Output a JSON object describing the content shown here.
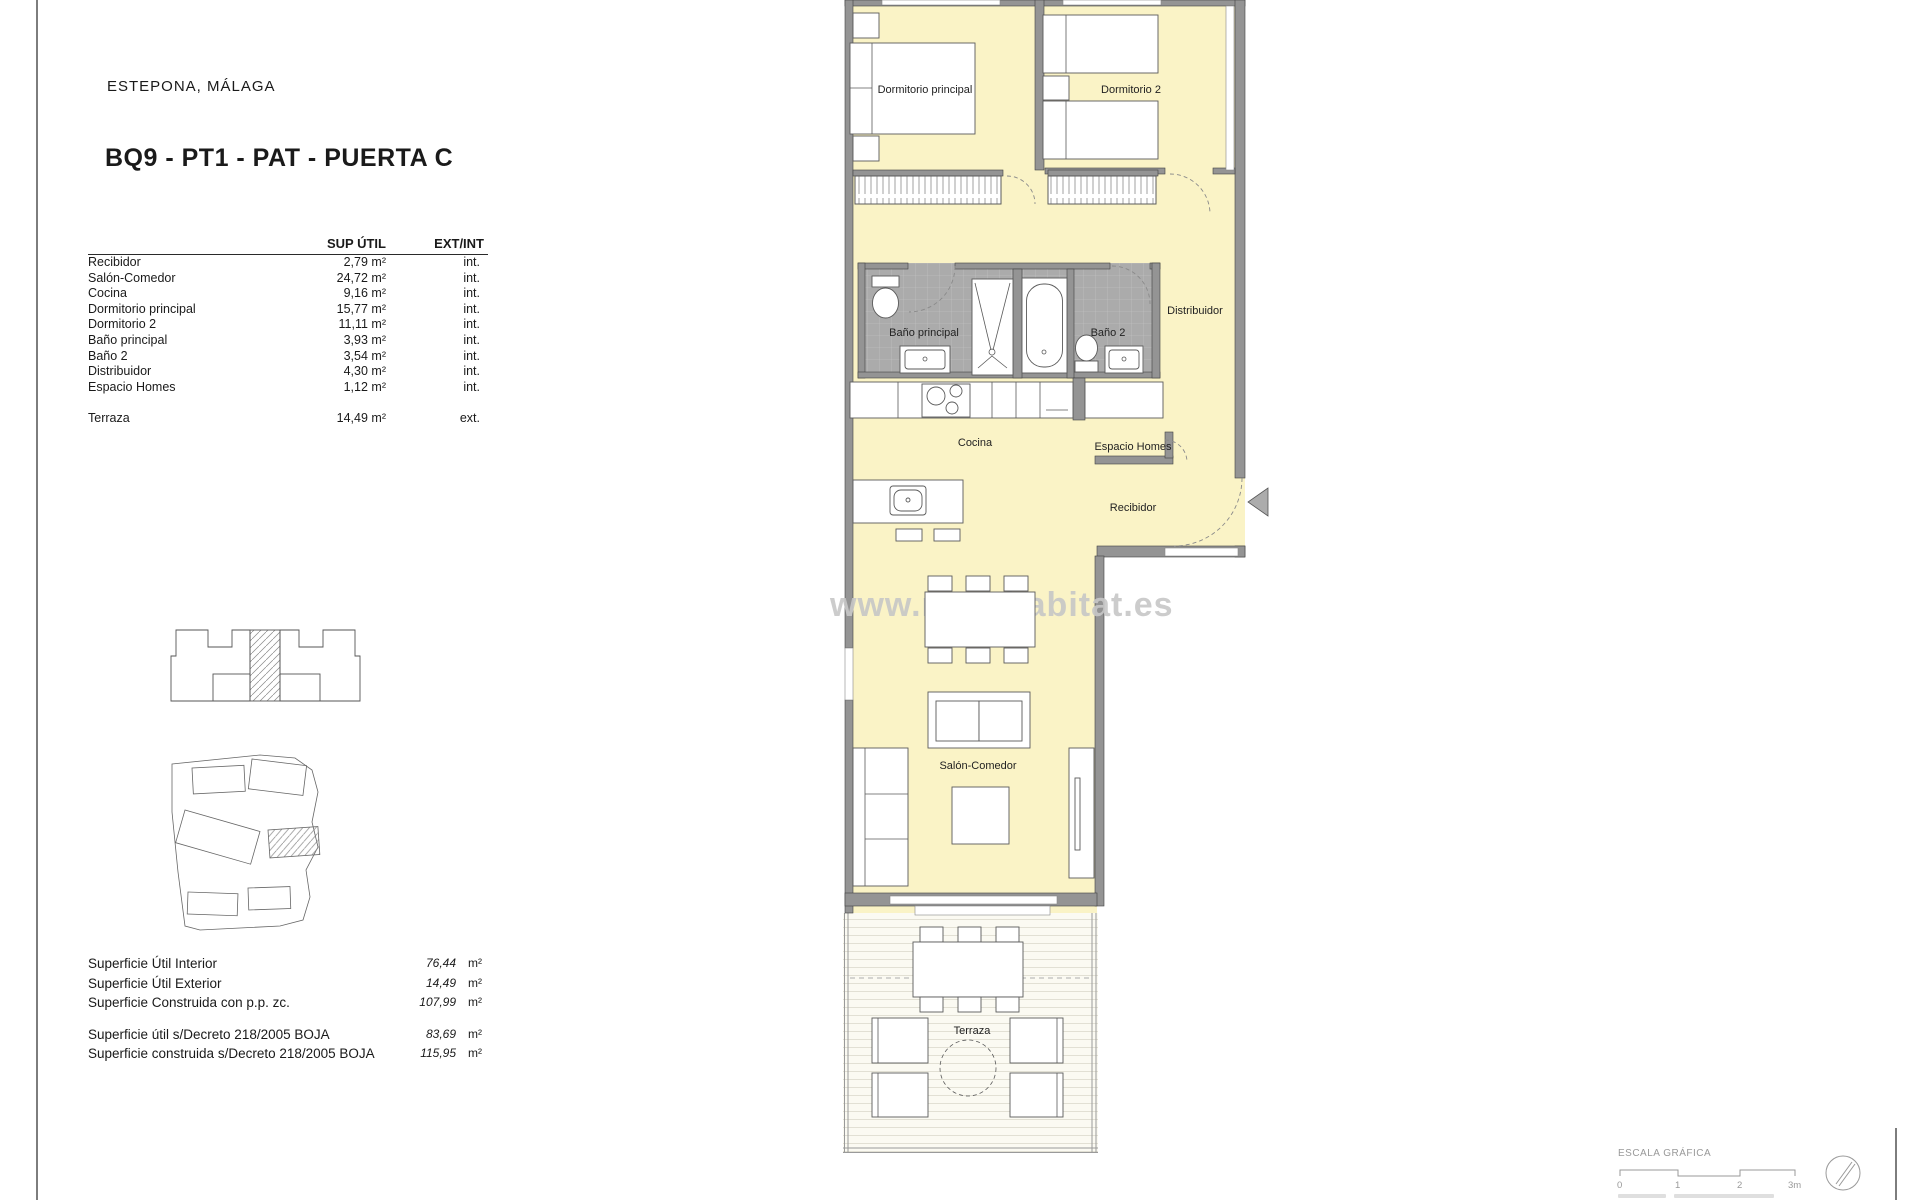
{
  "page": {
    "location": "ESTEPONA, MÁLAGA",
    "title": "BQ9 - PT1 - PAT - PUERTA C"
  },
  "table": {
    "headers": {
      "area": "SUP ÚTIL",
      "extint": "EXT/INT"
    },
    "rows": [
      {
        "name": "Recibidor",
        "area": "2,79 m²",
        "extint": "int."
      },
      {
        "name": "Salón-Comedor",
        "area": "24,72 m²",
        "extint": "int."
      },
      {
        "name": "Cocina",
        "area": "9,16 m²",
        "extint": "int."
      },
      {
        "name": "Dormitorio principal",
        "area": "15,77 m²",
        "extint": "int."
      },
      {
        "name": "Dormitorio 2",
        "area": "11,11 m²",
        "extint": "int."
      },
      {
        "name": "Baño principal",
        "area": "3,93 m²",
        "extint": "int."
      },
      {
        "name": "Baño 2",
        "area": "3,54 m²",
        "extint": "int."
      },
      {
        "name": "Distribuidor",
        "area": "4,30 m²",
        "extint": "int."
      },
      {
        "name": "Espacio Homes",
        "area": "1,12 m²",
        "extint": "int."
      },
      {
        "name": "Terraza",
        "area": "14,49 m²",
        "extint": "ext."
      }
    ]
  },
  "summary": {
    "block1": [
      {
        "label": "Superficie Útil Interior",
        "value": "76,44",
        "unit": "m²"
      },
      {
        "label": "Superficie Útil Exterior",
        "value": "14,49",
        "unit": "m²"
      },
      {
        "label": "Superficie Construida con p.p. zc.",
        "value": "107,99",
        "unit": "m²"
      }
    ],
    "block2": [
      {
        "label": "Superficie útil s/Decreto 218/2005 BOJA",
        "value": "83,69",
        "unit": "m²"
      },
      {
        "label": "Superficie construida s/Decreto 218/2005 BOJA",
        "value": "115,95",
        "unit": "m²"
      }
    ]
  },
  "plan": {
    "labels": {
      "dormitorio_principal": "Dormitorio principal",
      "dormitorio2": "Dormitorio 2",
      "bano_principal": "Baño principal",
      "bano2": "Baño 2",
      "distribuidor": "Distribuidor",
      "cocina": "Cocina",
      "espacio_homes": "Espacio Homes",
      "recibidor": "Recibidor",
      "salon_comedor": "Salón-Comedor",
      "terraza": "Terraza"
    }
  },
  "watermark": "www.novahabitat.es",
  "scalebar": {
    "title": "ESCALA GRÁFICA",
    "ticks": [
      "0",
      "1",
      "2",
      "3m"
    ]
  },
  "colors": {
    "floor": "#FAF3C6",
    "wall": "#949494",
    "bath_floor": "#ABABAB",
    "text": "#1A1A1A",
    "watermark": "#C7C7C7"
  }
}
